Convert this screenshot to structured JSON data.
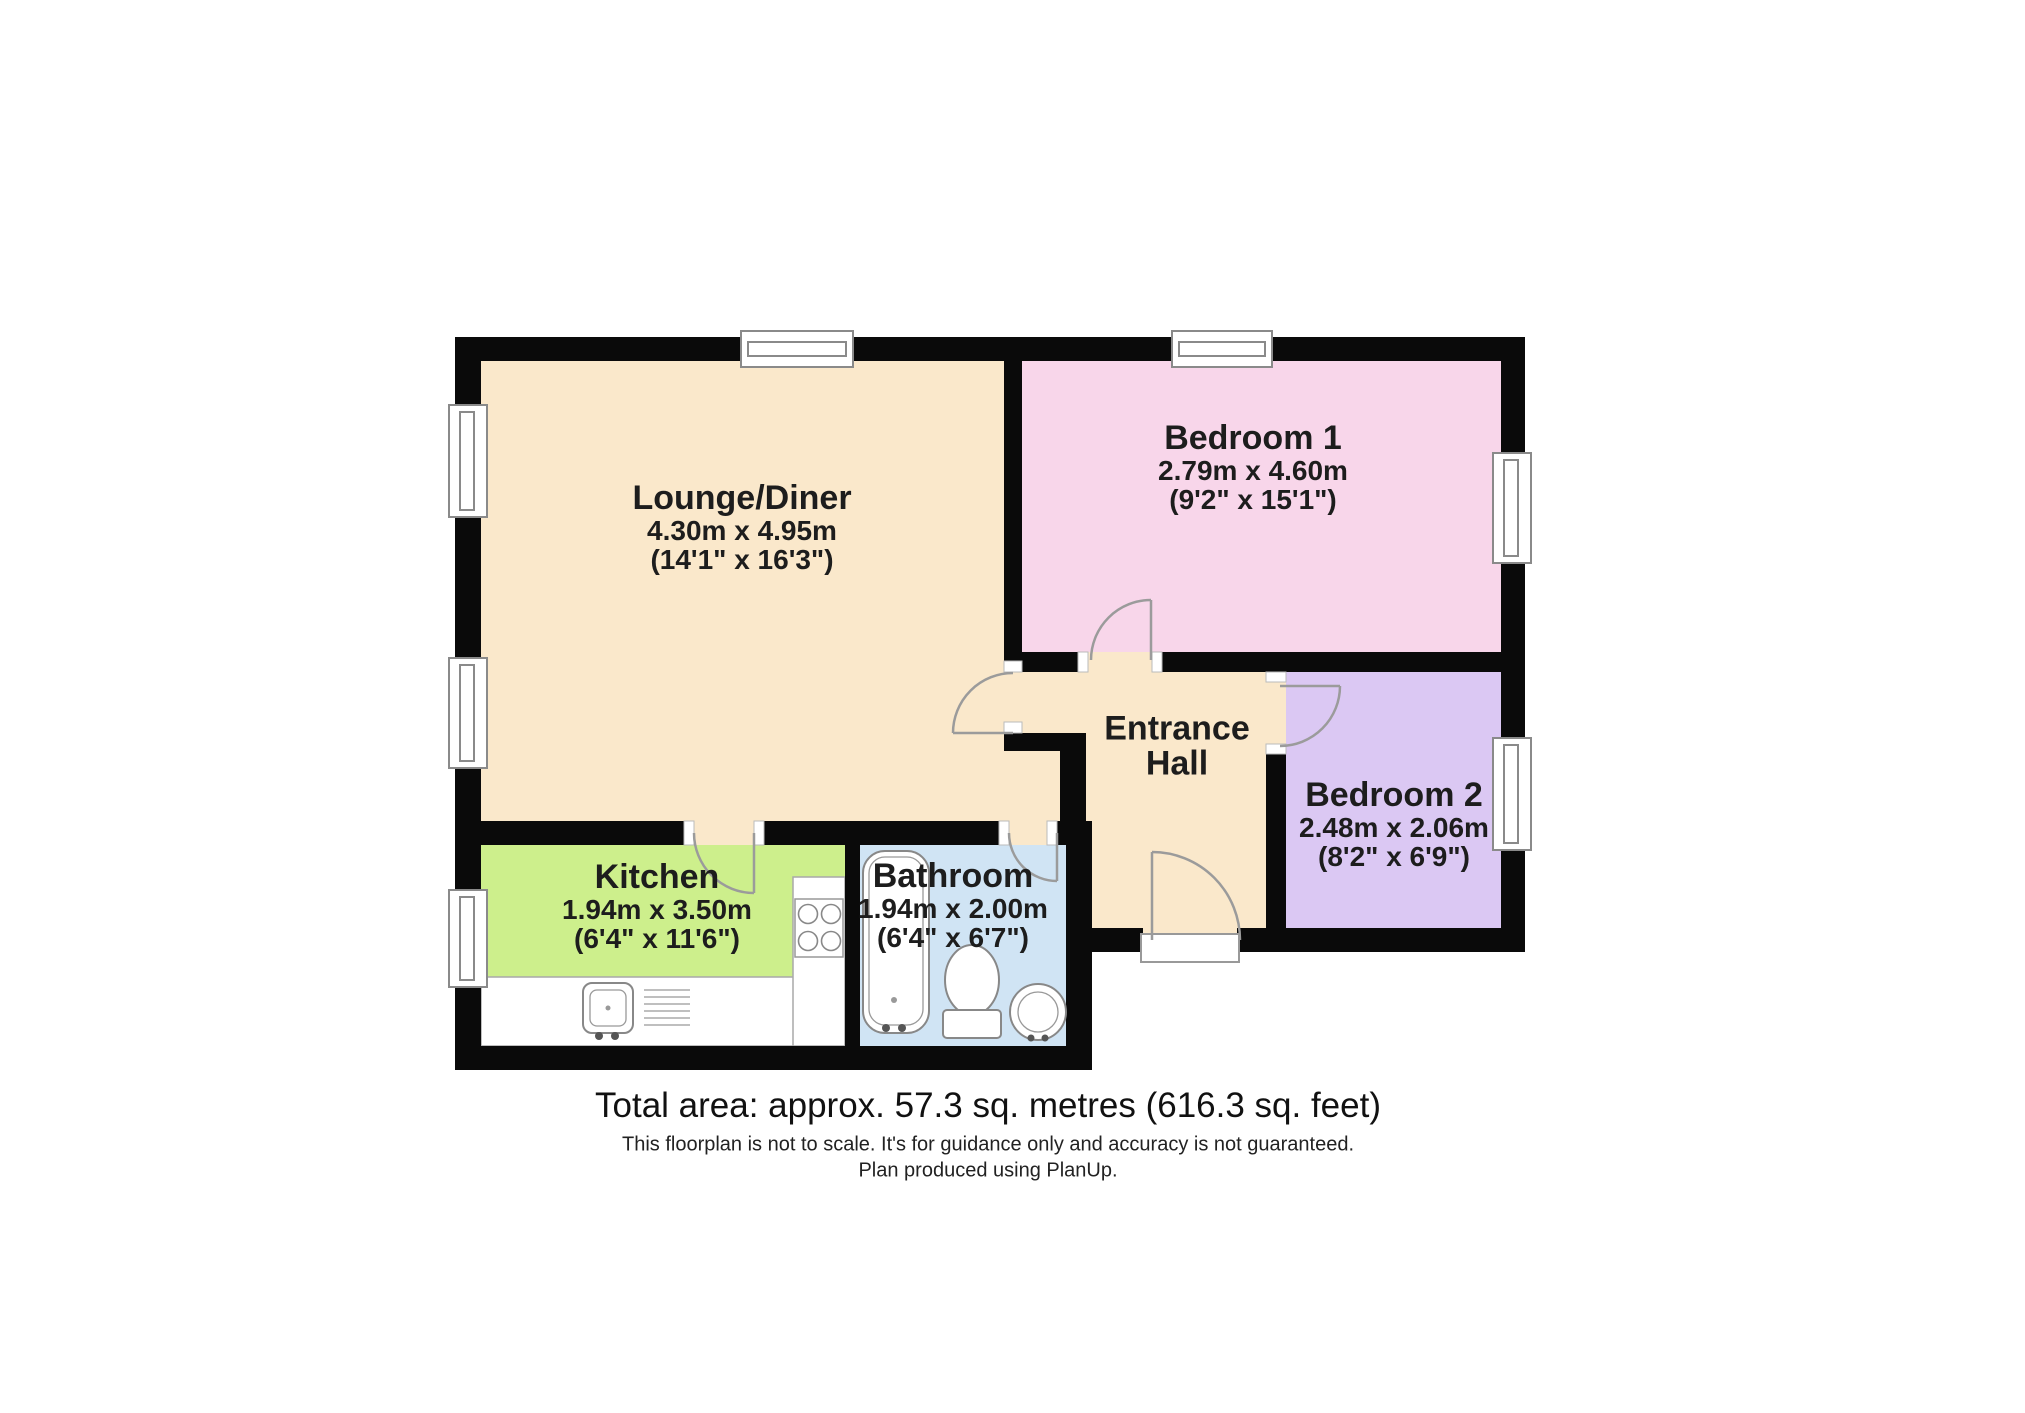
{
  "rooms": {
    "lounge": {
      "name": "Lounge/Diner",
      "metric": "4.30m x 4.95m",
      "imperial": "(14'1\" x 16'3\")"
    },
    "bedroom1": {
      "name": "Bedroom 1",
      "metric": "2.79m x 4.60m",
      "imperial": "(9'2\" x 15'1\")"
    },
    "bedroom2": {
      "name": "Bedroom 2",
      "metric": "2.48m x 2.06m",
      "imperial": "(8'2\" x 6'9\")"
    },
    "kitchen": {
      "name": "Kitchen",
      "metric": "1.94m x 3.50m",
      "imperial": "(6'4\" x 11'6\")"
    },
    "bathroom": {
      "name": "Bathroom",
      "metric": "1.94m x 2.00m",
      "imperial": "(6'4\" x 6'7\")"
    },
    "hall": {
      "line1": "Entrance",
      "line2": "Hall"
    }
  },
  "footer": {
    "total_area": "Total area: approx. 57.3 sq. metres (616.3 sq. feet)",
    "disclaimer": "This floorplan is not to scale. It's for guidance only and accuracy is not guaranteed.",
    "credit": "Plan produced using PlanUp."
  },
  "colors": {
    "lounge": "#FAE8CB",
    "hall": "#FAE8CB",
    "bedroom1": "#F8D6EA",
    "bedroom2": "#DBC8F3",
    "kitchen": "#CDEF8C",
    "bathroom": "#D0E4F4",
    "wall": "#0A0A0A"
  }
}
